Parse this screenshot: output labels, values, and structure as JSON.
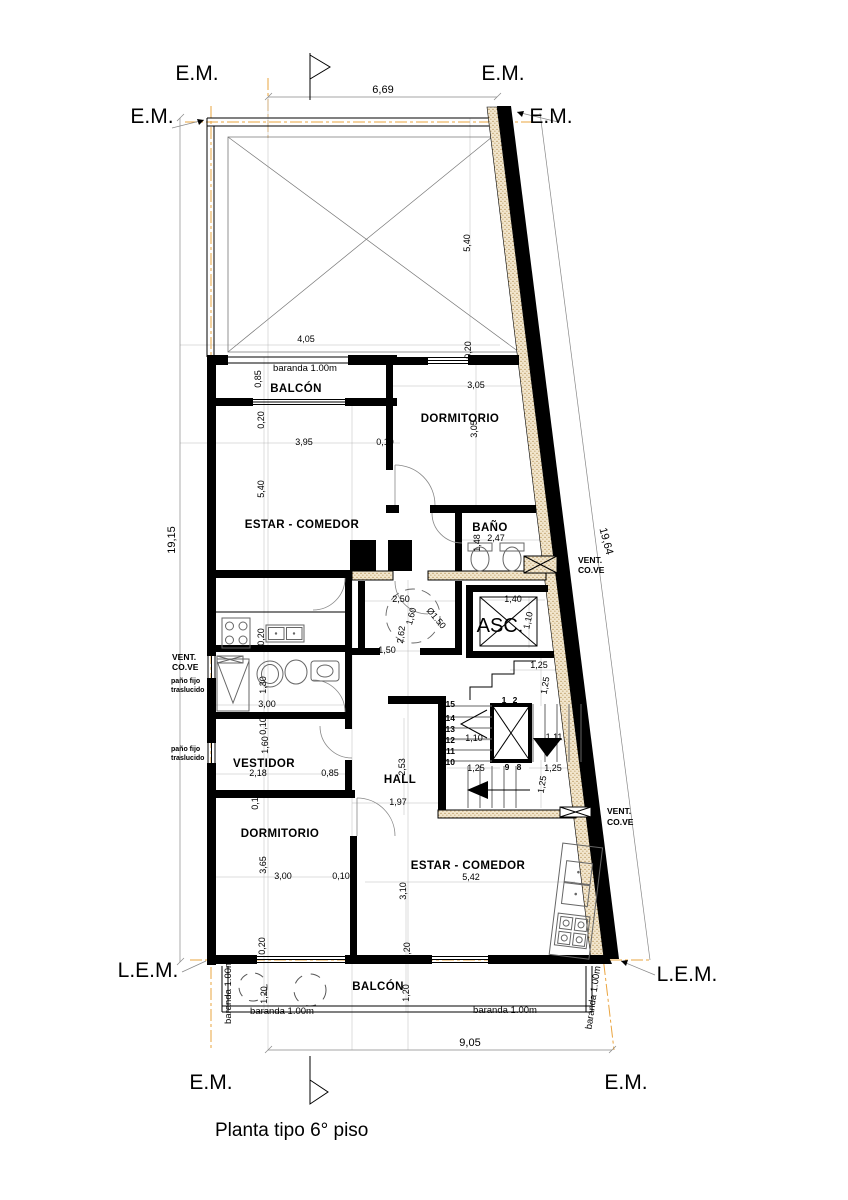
{
  "drawing": {
    "title": "Planta tipo 6° piso",
    "markers": {
      "em": "E.M.",
      "lem": "L.E.M."
    },
    "rooms": {
      "balcon_top": "BALCÓN",
      "dormitorio_top": "DORMITORIO",
      "estar_top": "ESTAR - COMEDOR",
      "bano": "BAÑO",
      "asc": "ASC.",
      "vestidor": "VESTIDOR",
      "hall": "HALL",
      "dormitorio_bottom": "DORMITORIO",
      "estar_bottom": "ESTAR - COMEDOR",
      "balcon_bottom": "BALCÓN"
    },
    "annotations": {
      "vent1": "VENT.",
      "vent2": "CO.VE",
      "pano1": "paño fijo",
      "pano2": "traslucido",
      "baranda": "baranda 1.00m"
    },
    "dims": {
      "w669": "6,69",
      "h1915": "19,15",
      "h1964": "19,64",
      "w905": "9,05",
      "d540": "5,40",
      "d020": "0,20",
      "d405": "4,05",
      "d085": "0,85",
      "d305": "3,05",
      "d395": "3,95",
      "d010": "0,10",
      "d247": "2,47",
      "d148": "1,48",
      "d250": "2,50",
      "d160": "1,60",
      "d150diam": "Ø1.50",
      "d262": "2,62",
      "d150": "1,50",
      "d140": "1,40",
      "d110": "1,10",
      "d130": "1,30",
      "d300": "3,00",
      "d218": "2,18",
      "d253": "2,53",
      "d197": "1,97",
      "d125": "1,25",
      "d111": "1,11",
      "d365": "3,65",
      "d310": "3,10",
      "d542": "5,42",
      "d120": "1,20"
    },
    "stair_numbers": {
      "s1": "1",
      "s2": "2",
      "s8": "8",
      "s9": "9",
      "s10": "10",
      "s11": "11",
      "s12": "12",
      "s13": "13",
      "s14": "14",
      "s15": "15"
    }
  }
}
